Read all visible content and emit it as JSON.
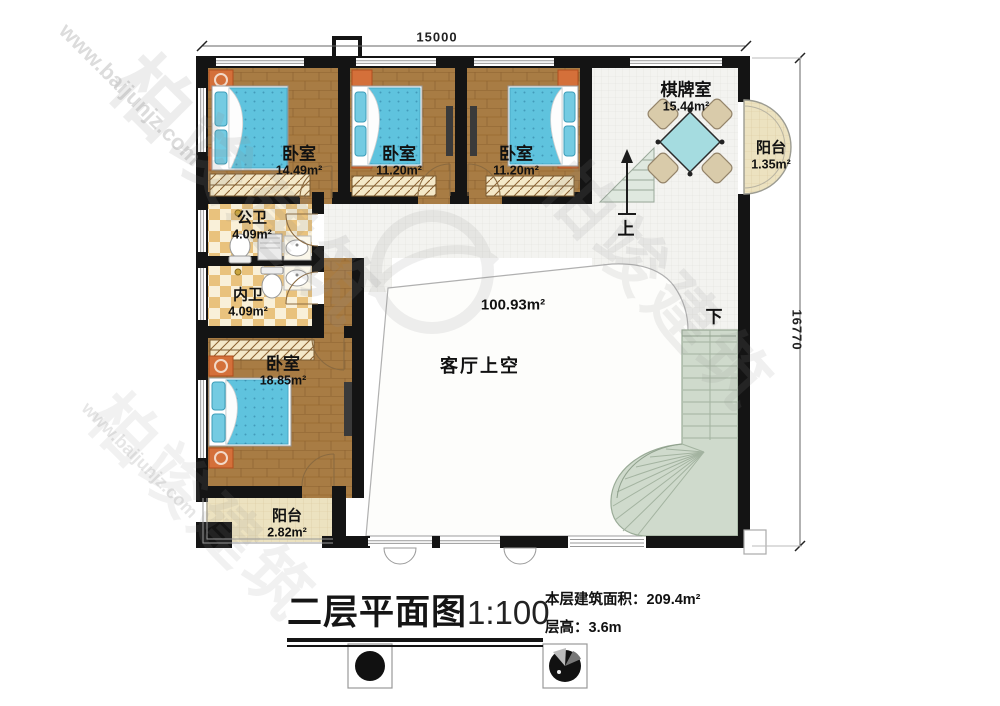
{
  "plan": {
    "dimensions": {
      "top": "15000",
      "right": "16770"
    },
    "rooms": {
      "bedroom1": {
        "name": "卧室",
        "area": "14.49m²"
      },
      "bedroom2": {
        "name": "卧室",
        "area": "11.20m²"
      },
      "bedroom3": {
        "name": "卧室",
        "area": "11.20m²"
      },
      "bedroom4": {
        "name": "卧室",
        "area": "18.85m²"
      },
      "chess_room": {
        "name": "棋牌室",
        "area": "15.44m²"
      },
      "balcony_right": {
        "name": "阳台",
        "area": "1.35m²"
      },
      "balcony_bottom": {
        "name": "阳台",
        "area": "2.82m²"
      },
      "bath_public": {
        "name": "公卫",
        "area": "4.09m²"
      },
      "bath_private": {
        "name": "内卫",
        "area": "4.09m²"
      },
      "living_void": {
        "name": "客厅上空",
        "area": "100.93m²"
      }
    },
    "stairs": {
      "up": "上",
      "down": "下"
    }
  },
  "title_block": {
    "title": "二层平面图",
    "scale": "1:100",
    "floor_area_label": "本层建筑面积：209.4m²",
    "floor_height_label": "层高：3.6m"
  },
  "watermark": {
    "site": "www.baijunjz.com",
    "brand": "柏竣建筑"
  },
  "colors": {
    "wall": "#141414",
    "wood": "#a87c44",
    "bed": "#5fc3de",
    "tile": "#f3f3f0",
    "sage": "#cfdacc",
    "balcony": "#ece2c0",
    "bath_checker": "#e9c27d",
    "table": "#a5dce0"
  }
}
